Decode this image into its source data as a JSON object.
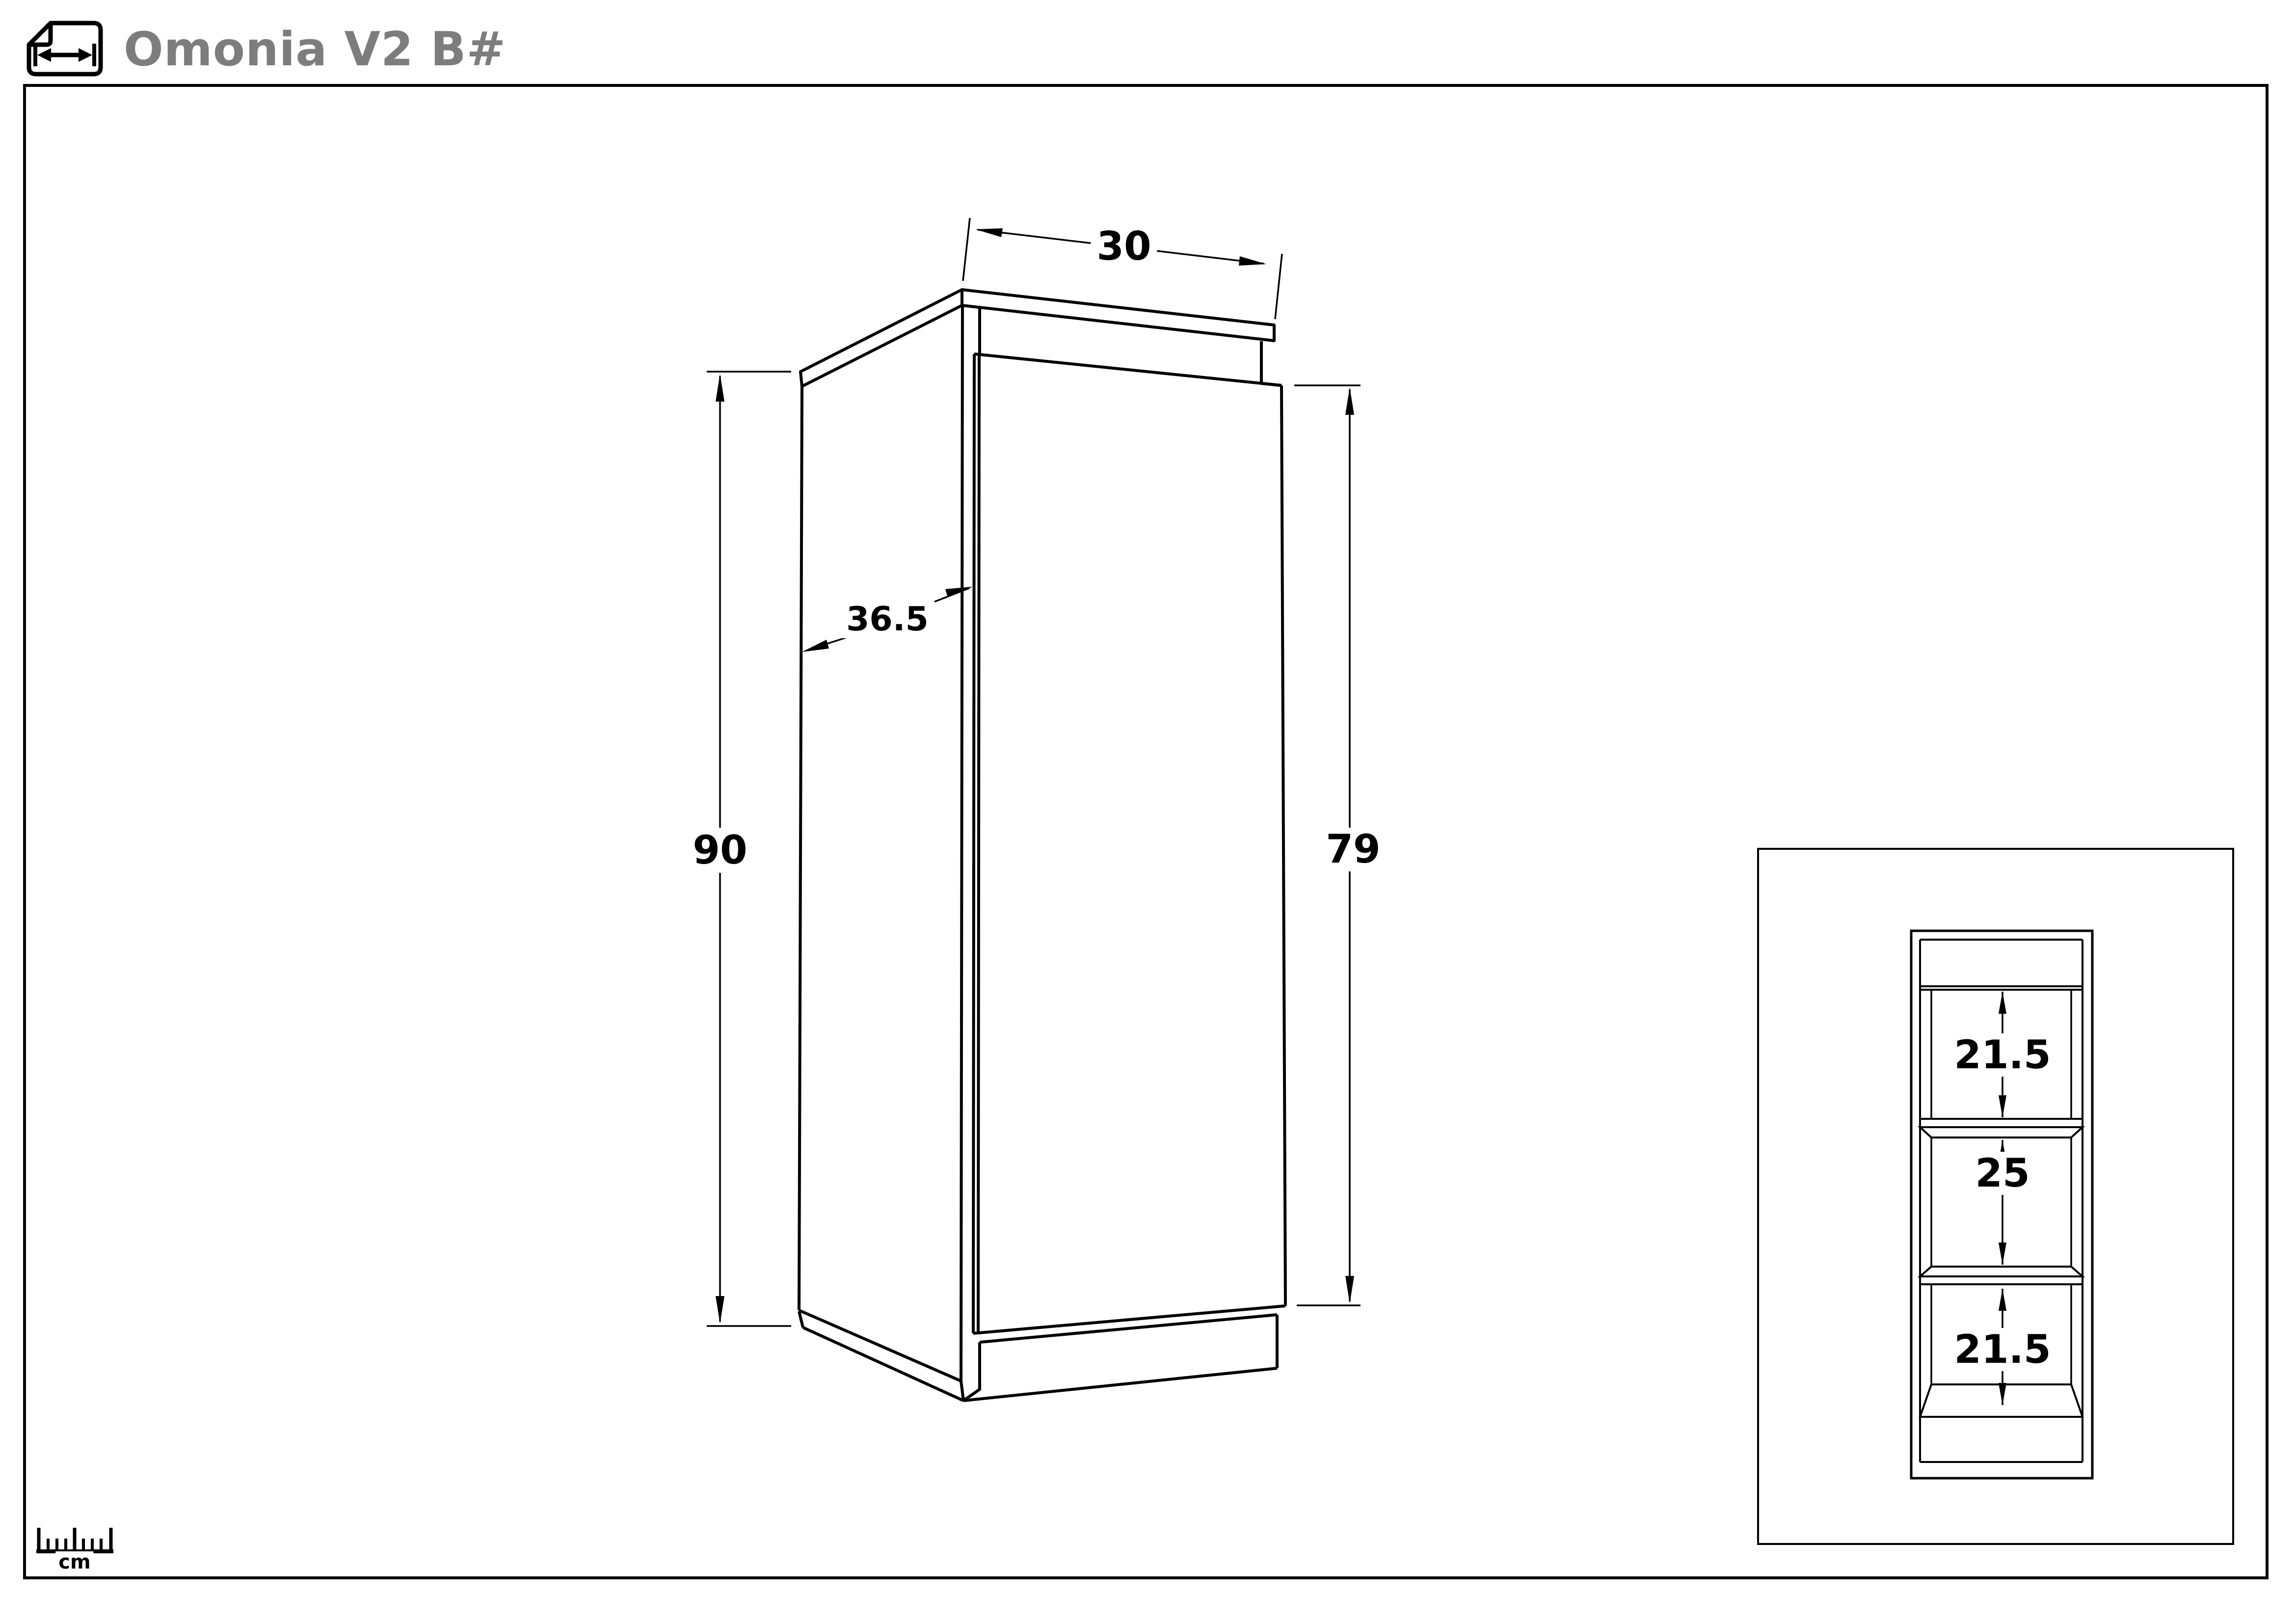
{
  "header": {
    "title": "Omonia V2 B#"
  },
  "footer": {
    "unit_label": "cm"
  },
  "iso_view": {
    "width_cm": "30",
    "depth_cm": "36.5",
    "height_cm": "90",
    "door_height_cm": "79"
  },
  "detail_view": {
    "top_gap_cm": "21.5",
    "middle_gap_cm": "25",
    "bottom_gap_cm": "21.5"
  },
  "colors": {
    "line": "#000000",
    "title": "#7d7d7d",
    "background": "#ffffff"
  }
}
